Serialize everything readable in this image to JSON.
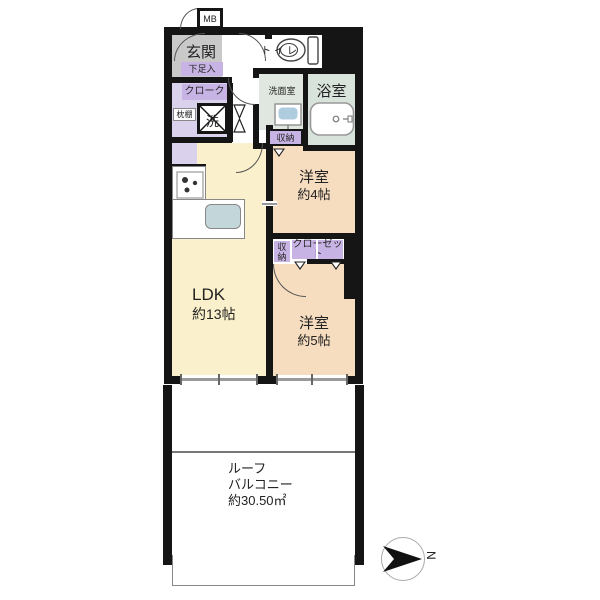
{
  "rooms": {
    "entrance": {
      "label": "玄関"
    },
    "ldk": {
      "label": "LDK",
      "size": "約13帖"
    },
    "western4": {
      "label": "洋室",
      "size": "約4帖"
    },
    "western5": {
      "label": "洋室",
      "size": "約5帖"
    },
    "toilet": {
      "label": "トイレ"
    },
    "washroom": {
      "label": "洗面室"
    },
    "bathroom": {
      "label": "浴室"
    },
    "balcony": {
      "label_line1": "ルーフ",
      "label_line2": "バルコニー",
      "size": "約30.50㎡"
    }
  },
  "storage": {
    "meter_box": "MB",
    "shoe_cabinet": "下足入",
    "cloak": "クローク",
    "pillow_shelf": "枕棚",
    "washer": "洗",
    "hall_storage": "収納",
    "mid_storage": "収納",
    "closet": "クローゼット"
  },
  "compass": {
    "north": "N"
  },
  "colors": {
    "wall": "#151515",
    "ldk_fill": "#FAF0CB",
    "bedroom_fill": "#F7DDC0",
    "entrance_fill": "#C9C9C9",
    "closet_label_fill": "#C8B4E4",
    "closet_area_fill": "#DAD2EC",
    "bathroom_fill": "#D8E3DC",
    "washroom_fill": "#E0E7E0",
    "basin_fill": "#AFCCDE",
    "kitchen_sink_fill": "#C3D6DA"
  }
}
